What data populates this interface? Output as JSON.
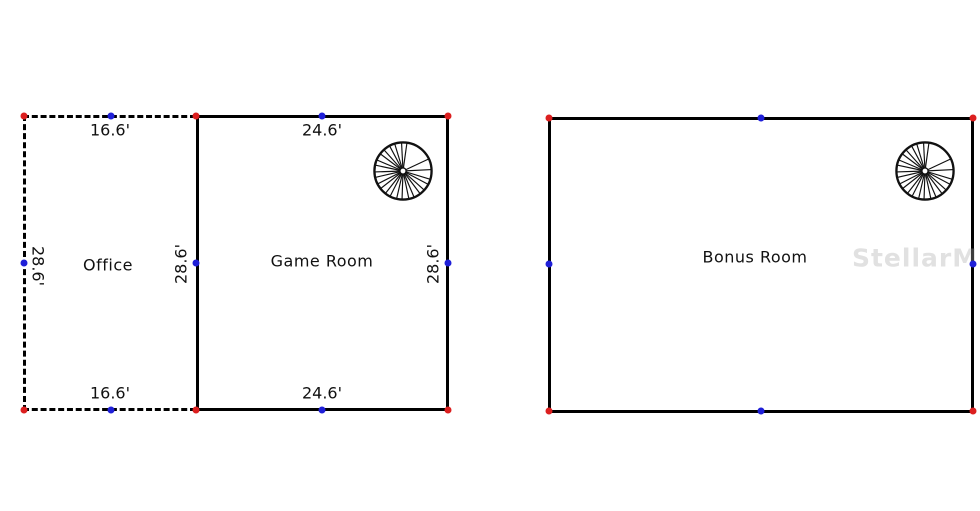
{
  "floor_plan_left": {
    "office": {
      "label": "Office",
      "dim_top": "16.6'",
      "dim_bottom": "16.6'",
      "dim_left": "28.6'",
      "dim_right": "28.6'"
    },
    "game_room": {
      "label": "Game Room",
      "dim_top": "24.6'",
      "dim_bottom": "24.6'",
      "dim_right": "28.6'"
    }
  },
  "floor_plan_right": {
    "bonus_room": {
      "label": "Bonus Room"
    }
  },
  "watermark": "StellarMLS",
  "icons": {
    "spiral_staircase": "spiral-staircase-icon",
    "corner_marker": "corner-vertex-dot",
    "midpoint_marker": "edge-midpoint-dot"
  },
  "colors": {
    "wall": "#000000",
    "corner_marker": "#dc1f1f",
    "midpoint_marker": "#1f1fd8",
    "text": "#111111",
    "watermark_text": "#e9e9e9"
  }
}
